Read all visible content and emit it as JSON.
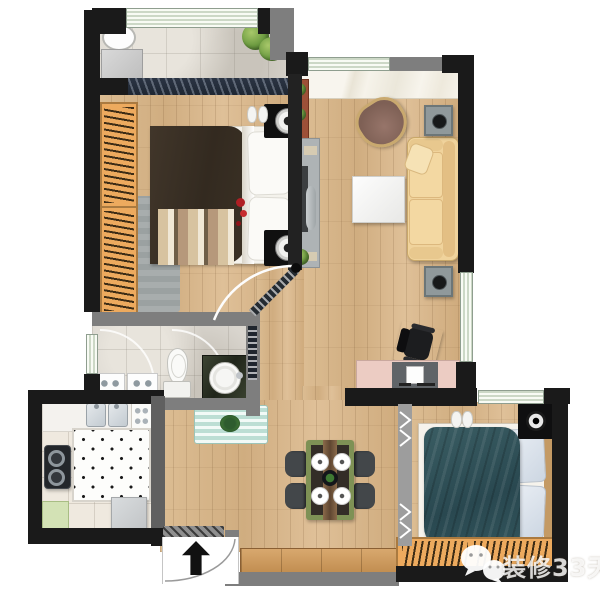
{
  "canvas": {
    "width": 600,
    "height": 592,
    "background": "#ffffff"
  },
  "type": "apartment-floor-plan-top-view",
  "watermark": {
    "text": "装修33天",
    "icon": "wechat-icon"
  },
  "entrance": {
    "symbol": "black up arrow",
    "location": "bottom-center"
  },
  "palette": {
    "wall_black": "#1a1a1a",
    "wall_gray": "#7e7e7e",
    "wood_floor": "#d8b88e",
    "stone_tile": "#d9d5ce",
    "kitchen_tile": "#efe9df",
    "marble_sill": "#f4f1e8",
    "window_glass": "#e2ecd9",
    "sofa": "#f0d39c",
    "armchair": "#8a6a5e",
    "master_duvet": "#3a2f24",
    "second_bed_blanket": "#31535a",
    "wardrobe_wood": "#edaa5e",
    "dining_table_frame": "#7e9155",
    "vanity_counter": "#2c3322",
    "desk": "#ecccc3",
    "bath_mat": "#bcded4",
    "kitchen_cabinet_green": "#d3e2b5",
    "rug_gray": "#9ba1a1"
  },
  "rooms": [
    {
      "name": "balcony",
      "position": "top-left",
      "floor": "stone-tile",
      "furniture": [
        "laundry-basin",
        "washing-machine",
        "potted-plants"
      ]
    },
    {
      "name": "master-bedroom",
      "position": "left",
      "floor": "wood",
      "furniture": [
        "wardrobe-with-hangers",
        "double-bed",
        "two-nightstands-with-lamps",
        "striped-foot-runner",
        "gray-rug",
        "slippers",
        "red-flowers"
      ]
    },
    {
      "name": "living-room",
      "position": "right",
      "floor": "wood",
      "furniture": [
        "three-seat-sofa",
        "armchair",
        "coffee-table",
        "tv-cabinet",
        "plant-stand",
        "two-speakers",
        "desk-with-monitor",
        "office-chair",
        "bay-window-sill"
      ]
    },
    {
      "name": "bathroom",
      "position": "center-left",
      "floor": "stone-tile",
      "furniture": [
        "toilet",
        "vanity-with-round-basin",
        "washer-units",
        "shower-arcs",
        "pocket-door",
        "bath-mat-with-crab"
      ]
    },
    {
      "name": "kitchen",
      "position": "bottom-left",
      "floor": "cream-tile",
      "furniture": [
        "double-sink",
        "two-burner-stove",
        "dotted-prep-mat",
        "appliance-cart",
        "green-base-cabinet",
        "tall-fridge"
      ]
    },
    {
      "name": "dining-room",
      "position": "bottom-center",
      "floor": "wood",
      "furniture": [
        "dining-table-for-four",
        "four-chairs",
        "four-place-settings",
        "center-bowl",
        "shoe-cabinet"
      ]
    },
    {
      "name": "second-bedroom",
      "position": "bottom-right",
      "floor": "wood",
      "furniture": [
        "bed-with-teal-blanket",
        "two-pillows",
        "nightstand-with-lamp",
        "wardrobe-with-hangers",
        "folding-partition-door",
        "slippers"
      ]
    },
    {
      "name": "entrance-hall",
      "position": "bottom",
      "floor": "wood",
      "furniture": [
        "entry-door-swing",
        "entry-direction-arrow",
        "hatched-threshold"
      ]
    }
  ]
}
